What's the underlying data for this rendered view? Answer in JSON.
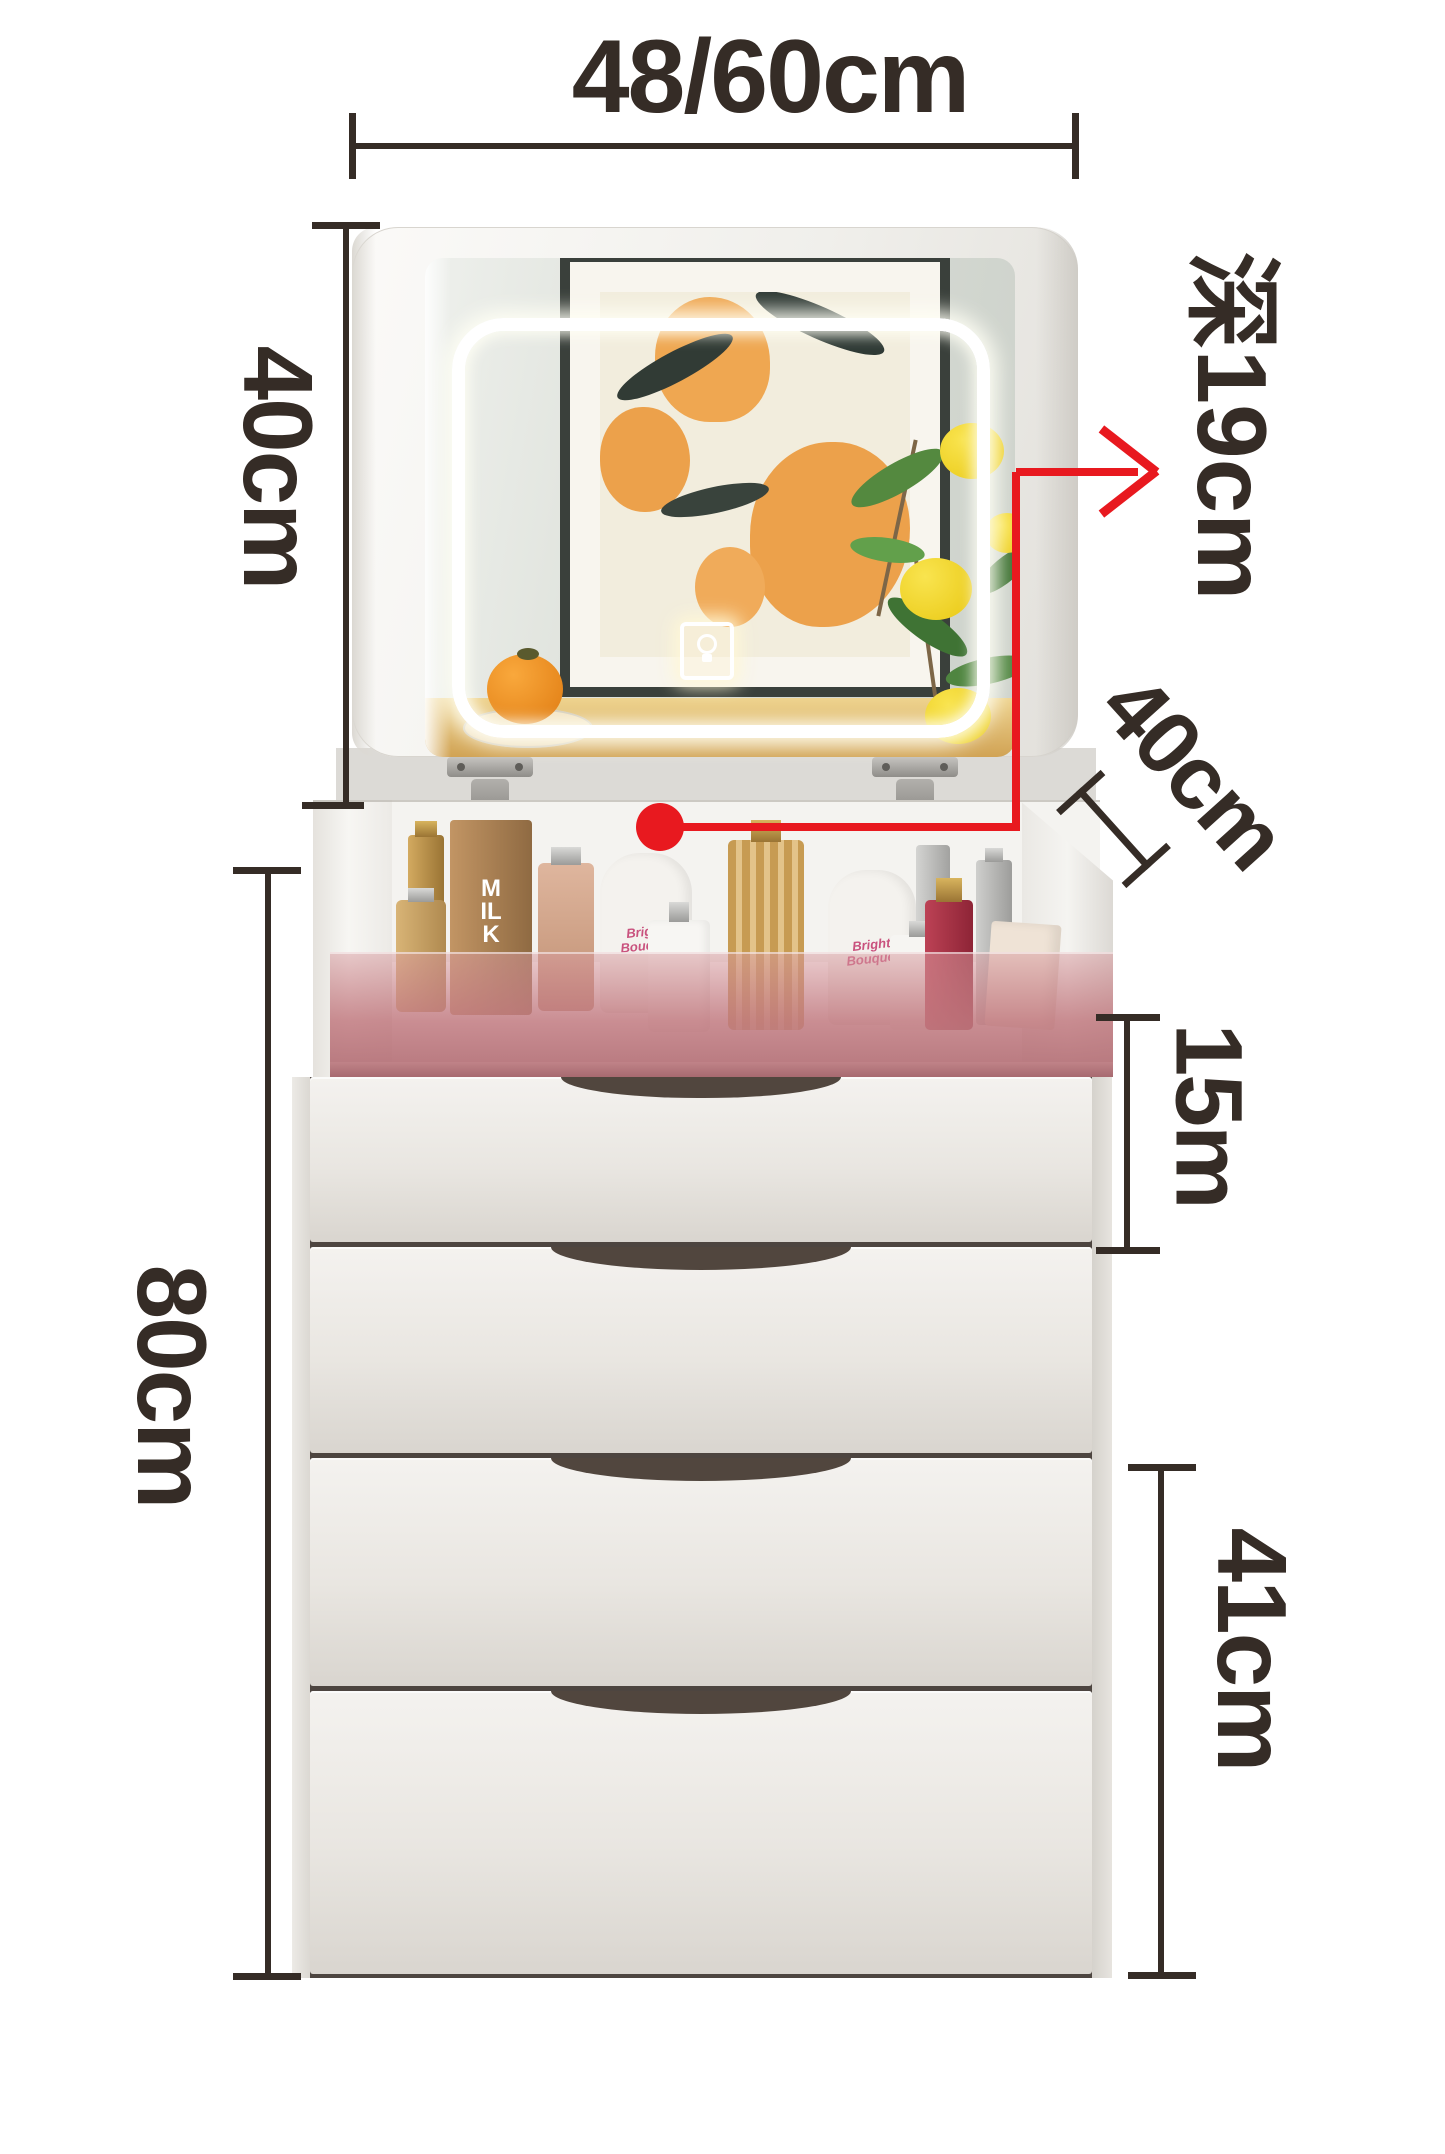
{
  "image_type": "product-dimension-diagram",
  "product": "flip-top mirror vanity chest with four drawers",
  "dimensions": {
    "top_width": {
      "label": "48/60cm"
    },
    "mirror_height": {
      "label": "40cm"
    },
    "depth_callout": {
      "label": "深19cm"
    },
    "top_depth": {
      "label": "40cm"
    },
    "first_drawer": {
      "label": "15m"
    },
    "total_height": {
      "label": "80cm"
    },
    "lower_drawers": {
      "label": "41cm"
    }
  },
  "cosmetics": {
    "tube_label": "Bright Bouquet",
    "carton_label": "MILK"
  },
  "icons": {
    "touch_switch": "light-bulb-icon"
  },
  "colors": {
    "annotation_text": "#352c26",
    "accent_red": "#e8191f",
    "glass_pink": "#b5767c",
    "led_glow": "#ffffff",
    "wood_shelf": "#d1a355",
    "artwork_orange": "#eca14b",
    "lemon_yellow": "#e9c813",
    "drawer_face": "#e9e6e1"
  }
}
